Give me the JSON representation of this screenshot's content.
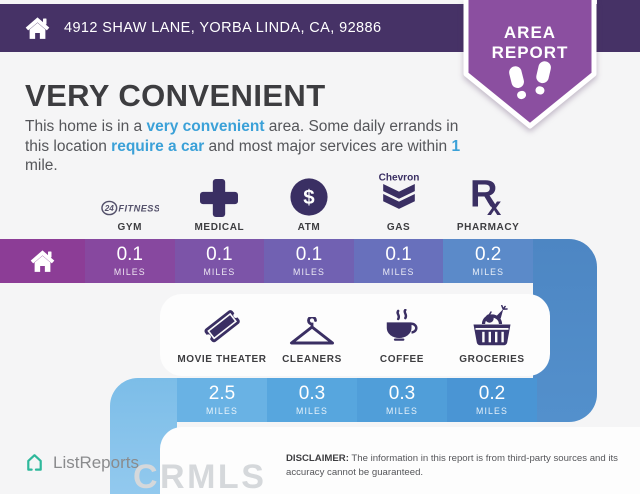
{
  "header": {
    "address": "4912 SHAW LANE, YORBA LINDA, CA, 92886"
  },
  "badge": {
    "line1": "AREA",
    "line2": "REPORT"
  },
  "intro": {
    "title": "VERY CONVENIENT",
    "parts": [
      "This home is in a ",
      "very convenient",
      " area. Some daily errands in this location ",
      "require a car",
      " and most major services are within ",
      "1",
      " mile."
    ]
  },
  "row1": {
    "items": [
      {
        "label": "GYM",
        "icon": "fitness-24-logo",
        "distance": "0.1",
        "unit": "MILES"
      },
      {
        "label": "MEDICAL",
        "icon": "medical-cross",
        "distance": "0.1",
        "unit": "MILES"
      },
      {
        "label": "ATM",
        "icon": "dollar-circle",
        "distance": "0.1",
        "unit": "MILES"
      },
      {
        "label": "GAS",
        "icon": "chevron-gas-logo",
        "distance": "0.1",
        "unit": "MILES"
      },
      {
        "label": "PHARMACY",
        "icon": "rx-symbol",
        "distance": "0.2",
        "unit": "MILES"
      }
    ]
  },
  "row2": {
    "items": [
      {
        "label": "MOVIE THEATER",
        "icon": "ticket",
        "distance": "2.5",
        "unit": "MILES"
      },
      {
        "label": "CLEANERS",
        "icon": "clothes-hanger",
        "distance": "0.3",
        "unit": "MILES"
      },
      {
        "label": "COFFEE",
        "icon": "coffee-cup",
        "distance": "0.3",
        "unit": "MILES"
      },
      {
        "label": "GROCERIES",
        "icon": "shopping-basket",
        "distance": "0.2",
        "unit": "MILES"
      }
    ]
  },
  "logos": {
    "gym": {
      "number": "24",
      "text": "FITNESS"
    },
    "gas": {
      "text": "Chevron"
    },
    "pharmacy": {
      "r": "R",
      "x": "x"
    },
    "atm": {
      "symbol": "$"
    }
  },
  "footer": {
    "brand": "ListReports",
    "watermark": "CRMLS",
    "disclaimer_label": "DISCLAIMER:",
    "disclaimer_text": " The information in this report is from third-party sources and its accuracy cannot be guaranteed."
  },
  "palette": {
    "header_bg": "#463266",
    "badge_bg": "#8b4fa0",
    "accent_blue": "#3ba1d8",
    "icon_purple": "#3a2f63",
    "brand_teal": "#2eb89b",
    "bar1": [
      "#8c3d96",
      "#87489f",
      "#7c54a8",
      "#7161b2",
      "#6870bc",
      "#5b8ac9"
    ],
    "bar2": [
      "#69b2e4",
      "#57a6de",
      "#509ed9",
      "#4a95d4"
    ]
  }
}
